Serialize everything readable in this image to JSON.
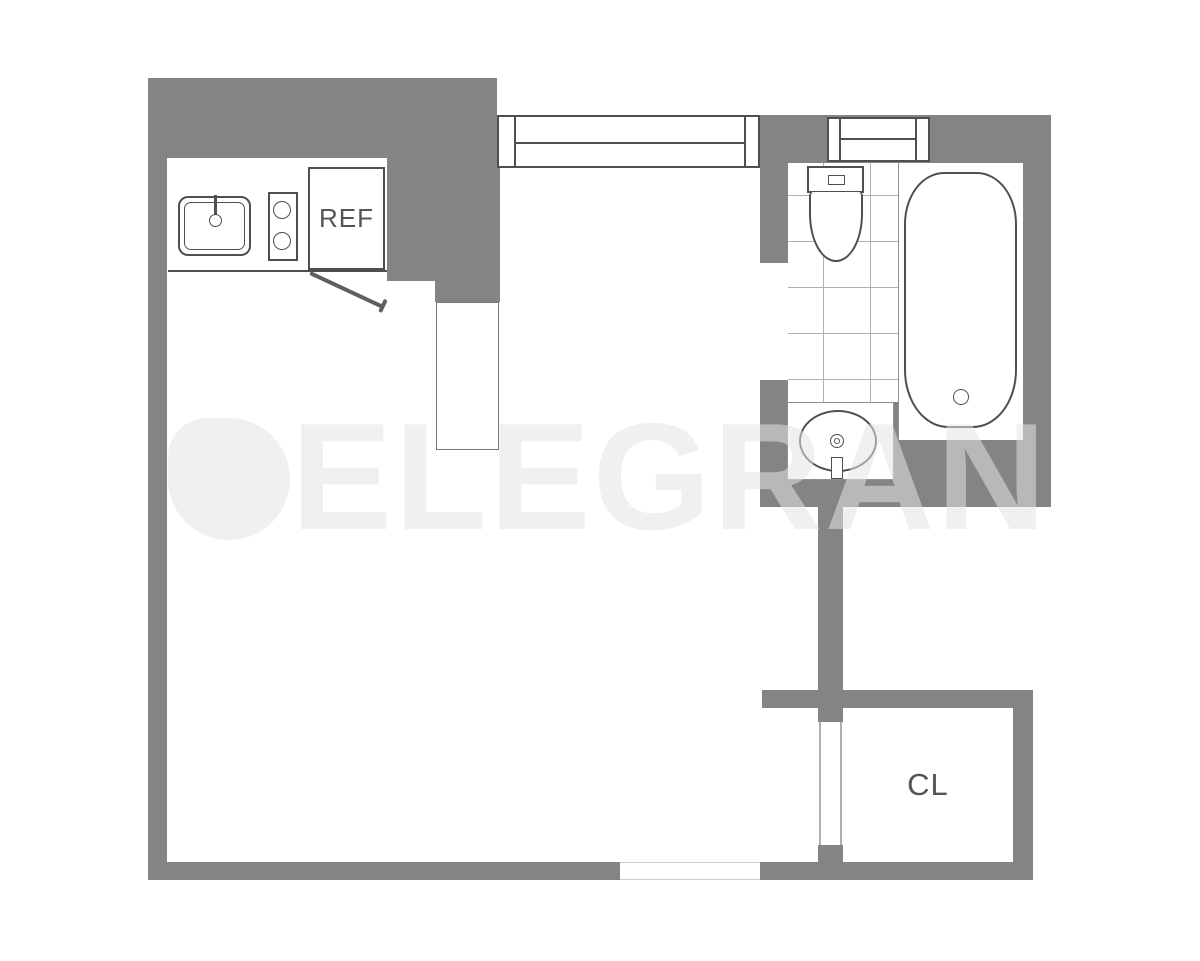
{
  "floorplan": {
    "title": "studio-apartment-floor-plan",
    "labels": {
      "refrigerator": "REF",
      "closet": "CL"
    },
    "watermark": {
      "brand": "ELEGRAN",
      "logo_icon": "elegran-circle-logo"
    },
    "colors": {
      "wall": "#848484",
      "fixture_line": "#4f4f4f",
      "light_line": "#8f8f8f",
      "tile_line": "#b0b0b0",
      "label_text": "#555555",
      "watermark_fill": "rgba(228,228,228,0.55)",
      "background": "#ffffff"
    },
    "fixtures": [
      "kitchen-sink",
      "stove-two-burner",
      "refrigerator",
      "kitchen-door-swing",
      "main-window",
      "bathroom-window",
      "toilet",
      "bathtub",
      "vanity-sink",
      "tile-floor",
      "bathroom-door-opening",
      "closet-door-opening",
      "entry-opening"
    ]
  }
}
